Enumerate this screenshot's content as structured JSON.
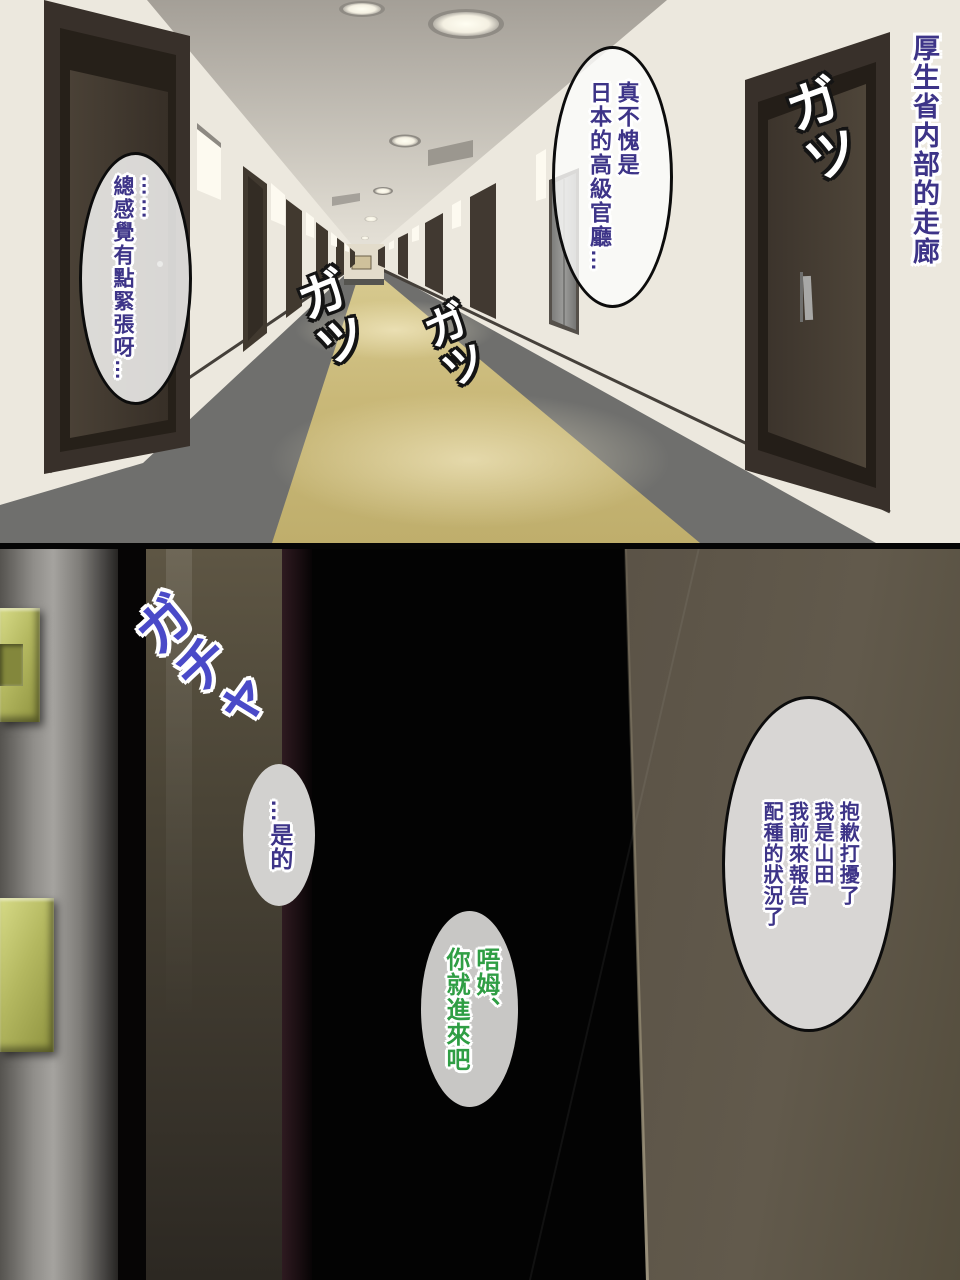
{
  "hallway": {
    "caption": "厚生省内部的走廊",
    "bubble_nervous": {
      "cols": [
        "……",
        "總感覺有點緊張呀…"
      ]
    },
    "bubble_admire": {
      "cols": [
        "真不愧是",
        "日本的高級官廳…"
      ]
    },
    "sfx_steps": [
      "ガツ",
      "ガツ",
      "ガツ"
    ]
  },
  "doorway": {
    "sfx_door": "ガチャ",
    "bubble_reply": {
      "cols": [
        "…是的"
      ]
    },
    "bubble_invite": {
      "cols": [
        "唔姆、",
        "你就進來吧"
      ]
    },
    "bubble_greeting": {
      "cols": [
        "抱歉打擾了",
        "我是山田",
        "我前來報告",
        "配種的狀況了"
      ]
    }
  },
  "colors": {
    "dialogue_text": "#3d3488",
    "invite_text": "#2f9e44",
    "sfx_door_text": "#4a4ac8",
    "sfx_step_text": "#ffffff",
    "carpet_tan": "#c9b878",
    "wall_cream": "#ebe7dd",
    "door_frame_brown": "#3b332b",
    "plaque_green": "#b9bb63",
    "bubble_fill": "#d8d6d4"
  }
}
